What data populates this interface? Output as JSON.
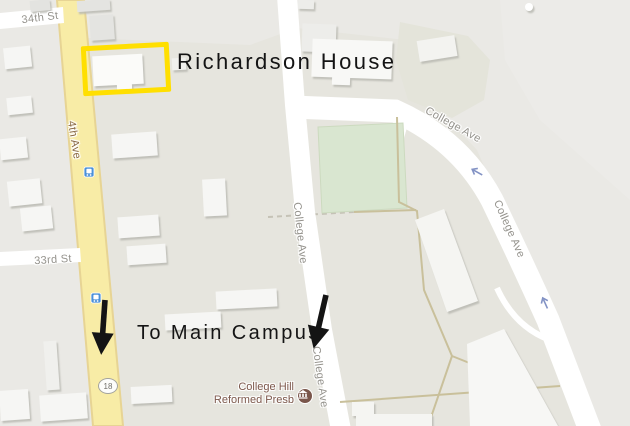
{
  "map": {
    "street_labels": [
      {
        "text": "34th St"
      },
      {
        "text": "4th Ave"
      },
      {
        "text": "33rd St"
      },
      {
        "text": "College Ave"
      },
      {
        "text": "College Ave"
      },
      {
        "text": "College Ave"
      },
      {
        "text": "College Ave"
      }
    ],
    "route_shield": "18",
    "poi": {
      "line1": "College Hill",
      "line2": "Reformed Presb",
      "icon": "place-of-worship-icon"
    },
    "transit_stops": {
      "icon": "bus-stop-icon",
      "count": "2"
    },
    "colors": {
      "road_yellow": "#f8eca6",
      "field_green": "#d9e6d0",
      "poi_brown": "#7a564b",
      "transit_blue": "#4a90d9"
    }
  },
  "annotations": {
    "title": "Richardson House",
    "campus_note": "To Main Campus",
    "highlight_color": "#ffdf00",
    "arrow_color": "#141414"
  }
}
